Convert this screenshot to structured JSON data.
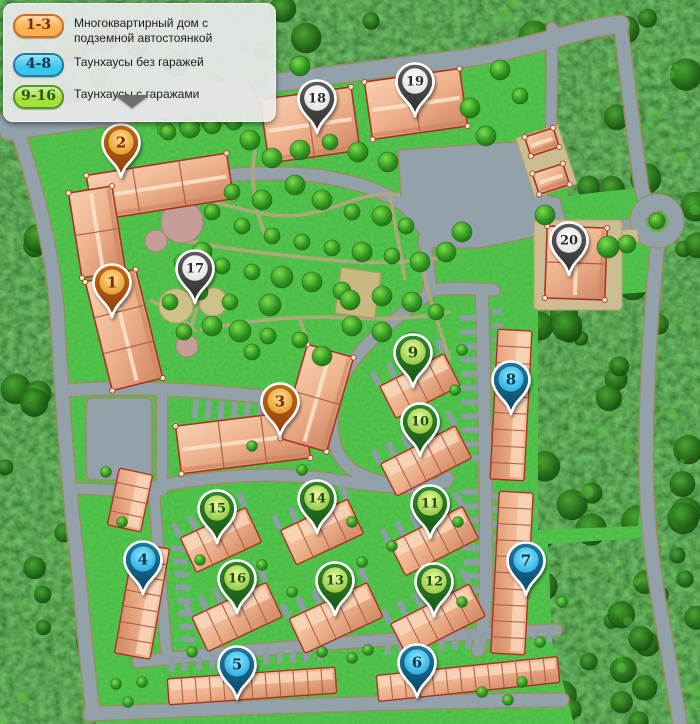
{
  "legend": {
    "items": [
      {
        "id": "apartment",
        "range": "1-3",
        "label": "Многоквартирный дом с подземной автостоянкой"
      },
      {
        "id": "townhouse_no_garage",
        "range": "4-8",
        "label": "Таунхаусы без гаражей"
      },
      {
        "id": "townhouse_garage",
        "range": "9-16",
        "label": "Таунхаусы с гаражами"
      }
    ]
  },
  "pin_styles": {
    "apartment": {
      "head_top": "#ffdf92",
      "head_bottom": "#e08c15",
      "body_top": "#c96a15",
      "body_bottom": "#8a3d05",
      "number_color": "#7c2800",
      "badge_fill": "#f9b04e",
      "badge_border": "#cf6d1d",
      "badge_text": "#7c2800"
    },
    "townhouse_no_garage": {
      "head_top": "#90eaff",
      "head_bottom": "#139fdb",
      "body_top": "#1f7ba6",
      "body_bottom": "#0a4663",
      "number_color": "#063450",
      "badge_fill": "#38c5ee",
      "badge_border": "#1d7ca5",
      "badge_text": "#063450"
    },
    "townhouse_garage": {
      "head_top": "#e9fa9c",
      "head_bottom": "#7fbe33",
      "body_top": "#2f8c2c",
      "body_bottom": "#175317",
      "number_color": "#1f4d0c",
      "badge_fill": "#a6e03c",
      "badge_border": "#55961d",
      "badge_text": "#2a570e"
    },
    "other": {
      "head_top": "#ffffff",
      "head_bottom": "#dcdcdc",
      "body_top": "#5f5f5f",
      "body_bottom": "#2d2d2d",
      "number_color": "#2b2b2b"
    }
  },
  "pins": [
    {
      "number": "1",
      "type": "apartment",
      "x": 112,
      "y": 282
    },
    {
      "number": "2",
      "type": "apartment",
      "x": 121,
      "y": 142
    },
    {
      "number": "3",
      "type": "apartment",
      "x": 280,
      "y": 401
    },
    {
      "number": "4",
      "type": "townhouse_no_garage",
      "x": 143,
      "y": 559
    },
    {
      "number": "5",
      "type": "townhouse_no_garage",
      "x": 237,
      "y": 664
    },
    {
      "number": "6",
      "type": "townhouse_no_garage",
      "x": 417,
      "y": 662
    },
    {
      "number": "7",
      "type": "townhouse_no_garage",
      "x": 526,
      "y": 560
    },
    {
      "number": "8",
      "type": "townhouse_no_garage",
      "x": 511,
      "y": 379
    },
    {
      "number": "9",
      "type": "townhouse_garage",
      "x": 413,
      "y": 352
    },
    {
      "number": "10",
      "type": "townhouse_garage",
      "x": 420,
      "y": 421
    },
    {
      "number": "11",
      "type": "townhouse_garage",
      "x": 430,
      "y": 503
    },
    {
      "number": "12",
      "type": "townhouse_garage",
      "x": 434,
      "y": 581
    },
    {
      "number": "13",
      "type": "townhouse_garage",
      "x": 335,
      "y": 580
    },
    {
      "number": "14",
      "type": "townhouse_garage",
      "x": 317,
      "y": 498
    },
    {
      "number": "15",
      "type": "townhouse_garage",
      "x": 217,
      "y": 508
    },
    {
      "number": "16",
      "type": "townhouse_garage",
      "x": 237,
      "y": 578
    },
    {
      "number": "17",
      "type": "other",
      "x": 195,
      "y": 268
    },
    {
      "number": "18",
      "type": "other",
      "x": 317,
      "y": 98
    },
    {
      "number": "19",
      "type": "other",
      "x": 415,
      "y": 81
    },
    {
      "number": "20",
      "type": "other",
      "x": 569,
      "y": 240
    }
  ]
}
